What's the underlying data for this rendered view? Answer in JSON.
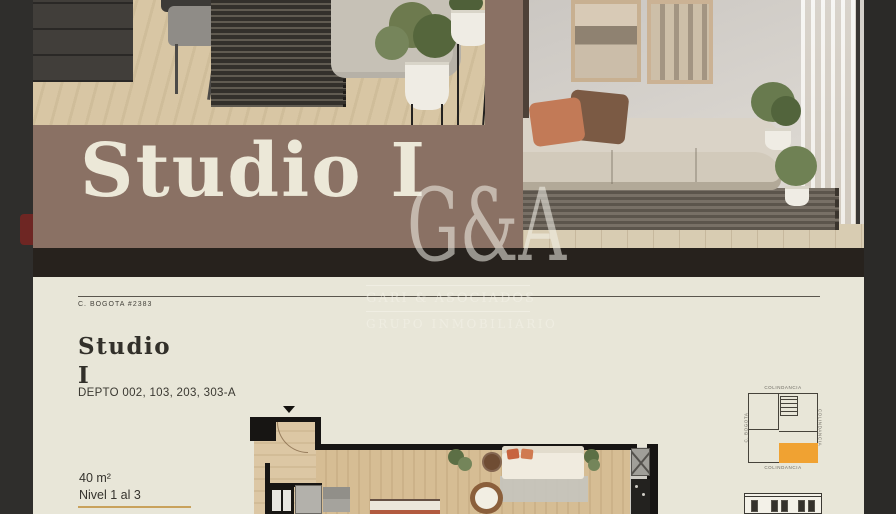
{
  "banner": {
    "title": "Studio I"
  },
  "watermark": {
    "monogram": "G&A",
    "company": "GARI & ASOCIADOS",
    "tagline": "GRUPO INMOBILIARIO"
  },
  "page": {
    "reference": "C. BOGOTA #2383",
    "title_line1": "Studio",
    "title_line2": "I",
    "units": "DEPTO 002, 103, 203, 303-A",
    "area": "40 m²",
    "level": "Nivel 1 al 3"
  },
  "keyplan": {
    "label_top": "COLINDANCIA",
    "label_bottom": "COLINDANCIA",
    "label_left": "C. BOGOTA",
    "label_right": "COLINDANCIA",
    "highlight_color": "#f0a232"
  },
  "colors": {
    "banner_brown": "#8a7164",
    "page_cream": "#e8e6d8",
    "accent_gold": "#c9a25c",
    "ink": "#32302a",
    "gutter_dark": "#2d2c2a"
  }
}
